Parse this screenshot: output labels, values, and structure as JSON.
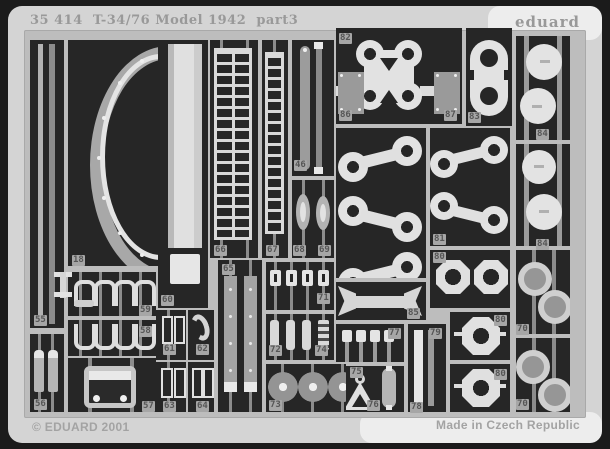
{
  "header": {
    "catalog": "35 414",
    "title": "T-34/76 Model 1942",
    "part": "part3",
    "brand": "eduard"
  },
  "footer": {
    "copyright": "© EDUARD 2001",
    "origin": "Made in Czech Republic"
  },
  "colors": {
    "mat": "#d4d4d4",
    "sheet_frame": "#bdbdbd",
    "cell_bg": "#262626",
    "part_gray": "#a0a0a0",
    "part_bright": "#e4e4e4",
    "label_chip": "#a6a6a6",
    "label_text": "#565656",
    "surround": "#1b1b1b",
    "header_text": "#999999"
  },
  "part_labels": [
    {
      "n": "18",
      "x": 72,
      "y": 255
    },
    {
      "n": "55",
      "x": 34,
      "y": 315
    },
    {
      "n": "56",
      "x": 34,
      "y": 399
    },
    {
      "n": "57",
      "x": 142,
      "y": 401
    },
    {
      "n": "58",
      "x": 139,
      "y": 326
    },
    {
      "n": "59",
      "x": 139,
      "y": 305
    },
    {
      "n": "60",
      "x": 161,
      "y": 295
    },
    {
      "n": "61",
      "x": 163,
      "y": 344
    },
    {
      "n": "62",
      "x": 196,
      "y": 344
    },
    {
      "n": "63",
      "x": 163,
      "y": 401
    },
    {
      "n": "64",
      "x": 196,
      "y": 401
    },
    {
      "n": "65",
      "x": 222,
      "y": 264
    },
    {
      "n": "66",
      "x": 214,
      "y": 245
    },
    {
      "n": "67",
      "x": 266,
      "y": 245
    },
    {
      "n": "68",
      "x": 293,
      "y": 245
    },
    {
      "n": "69",
      "x": 318,
      "y": 245
    },
    {
      "n": "46",
      "x": 294,
      "y": 160
    },
    {
      "n": "71",
      "x": 317,
      "y": 293
    },
    {
      "n": "72",
      "x": 269,
      "y": 345
    },
    {
      "n": "74",
      "x": 315,
      "y": 345
    },
    {
      "n": "73",
      "x": 269,
      "y": 400
    },
    {
      "n": "75",
      "x": 350,
      "y": 367
    },
    {
      "n": "76",
      "x": 367,
      "y": 400
    },
    {
      "n": "77",
      "x": 388,
      "y": 328
    },
    {
      "n": "78",
      "x": 410,
      "y": 402
    },
    {
      "n": "79",
      "x": 429,
      "y": 328
    },
    {
      "n": "80",
      "x": 433,
      "y": 252
    },
    {
      "n": "80",
      "x": 494,
      "y": 315
    },
    {
      "n": "80",
      "x": 494,
      "y": 369
    },
    {
      "n": "81",
      "x": 433,
      "y": 234
    },
    {
      "n": "82",
      "x": 339,
      "y": 33
    },
    {
      "n": "83",
      "x": 468,
      "y": 112
    },
    {
      "n": "84",
      "x": 536,
      "y": 129
    },
    {
      "n": "84",
      "x": 536,
      "y": 239
    },
    {
      "n": "85",
      "x": 407,
      "y": 308
    },
    {
      "n": "86",
      "x": 339,
      "y": 110
    },
    {
      "n": "87",
      "x": 444,
      "y": 110
    },
    {
      "n": "70",
      "x": 516,
      "y": 324
    },
    {
      "n": "70",
      "x": 516,
      "y": 399
    }
  ]
}
